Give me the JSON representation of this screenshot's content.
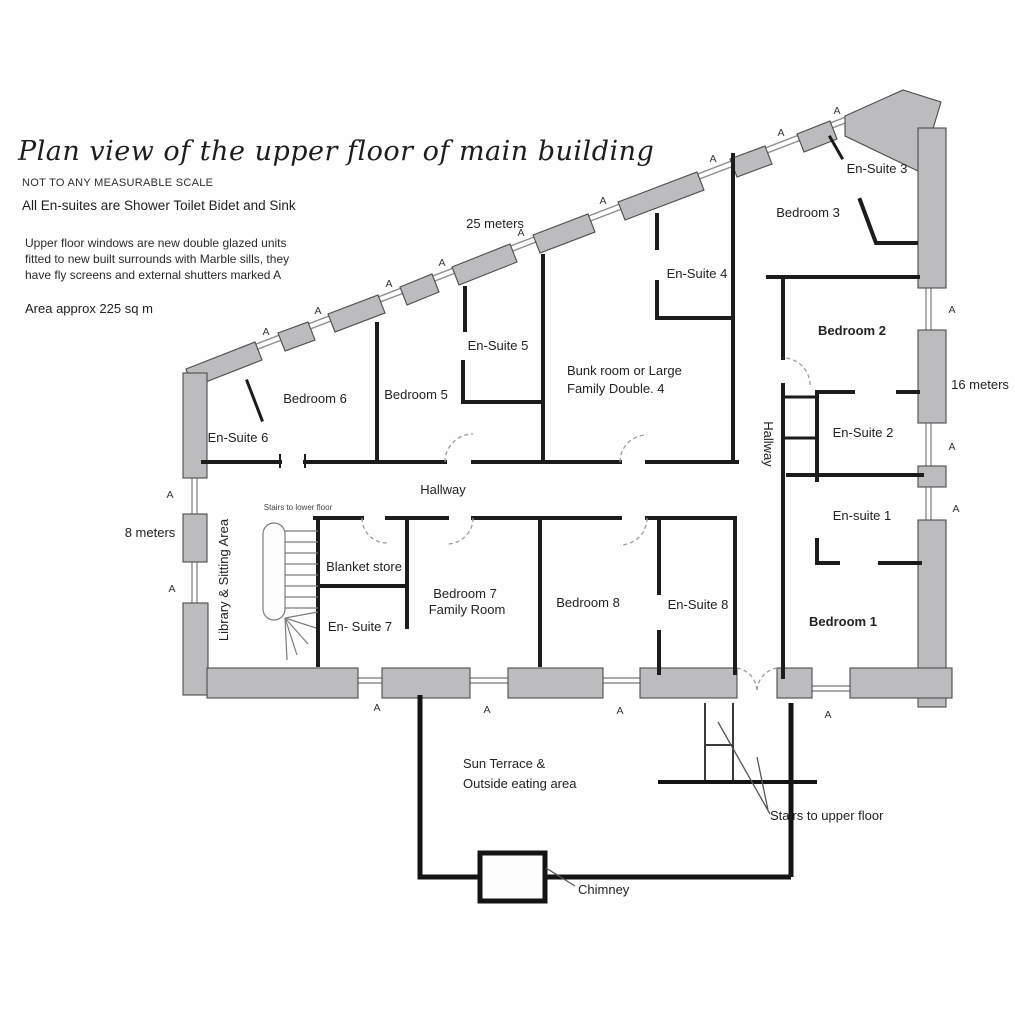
{
  "header": {
    "title": "Plan view of the upper floor of main building",
    "scale_note": "NOT TO ANY MEASURABLE SCALE",
    "ensuite_note": "All En-suites are Shower Toilet Bidet and Sink",
    "window_note_line1": "Upper floor windows are new double glazed units",
    "window_note_line2": "fitted to new built surrounds with Marble sills, they",
    "window_note_line3": "have fly screens and external shutters marked A",
    "area_note": "Area approx 225 sq m"
  },
  "dimensions": {
    "top": "25 meters",
    "right": "16 meters",
    "left": "8 meters"
  },
  "markers": {
    "window_shutter": "A"
  },
  "rooms": {
    "ensuite3": "En-Suite 3",
    "bedroom3": "Bedroom 3",
    "ensuite4": "En-Suite 4",
    "bedroom2": "Bedroom 2",
    "ensuite5": "En-Suite 5",
    "bunkroom_line1": "Bunk room or Large",
    "bunkroom_line2": "Family Double. 4",
    "bedroom6": "Bedroom 6",
    "bedroom5": "Bedroom 5",
    "ensuite6": "En-Suite 6",
    "hallway_right": "Hallway",
    "ensuite2": "En-Suite 2",
    "hallway_center": "Hallway",
    "ensuite1": "En-suite 1",
    "stairs_lower": "Stairs to lower floor",
    "library": "Library & Sitting Area",
    "blanket": "Blanket store",
    "bedroom7_line1": "Bedroom 7",
    "bedroom7_line2": "Family Room",
    "bedroom8": "Bedroom 8",
    "ensuite8": "En-Suite 8",
    "ensuite7": "En- Suite 7",
    "bedroom1": "Bedroom 1",
    "sun_terrace_line1": "Sun Terrace &",
    "sun_terrace_line2": "Outside eating area",
    "stairs_upper": "Stairs to upper floor",
    "chimney": "Chimney"
  },
  "colors": {
    "wall_fill": "#bcbcbe",
    "line": "#1c1c1c",
    "background": "#fefefe"
  }
}
